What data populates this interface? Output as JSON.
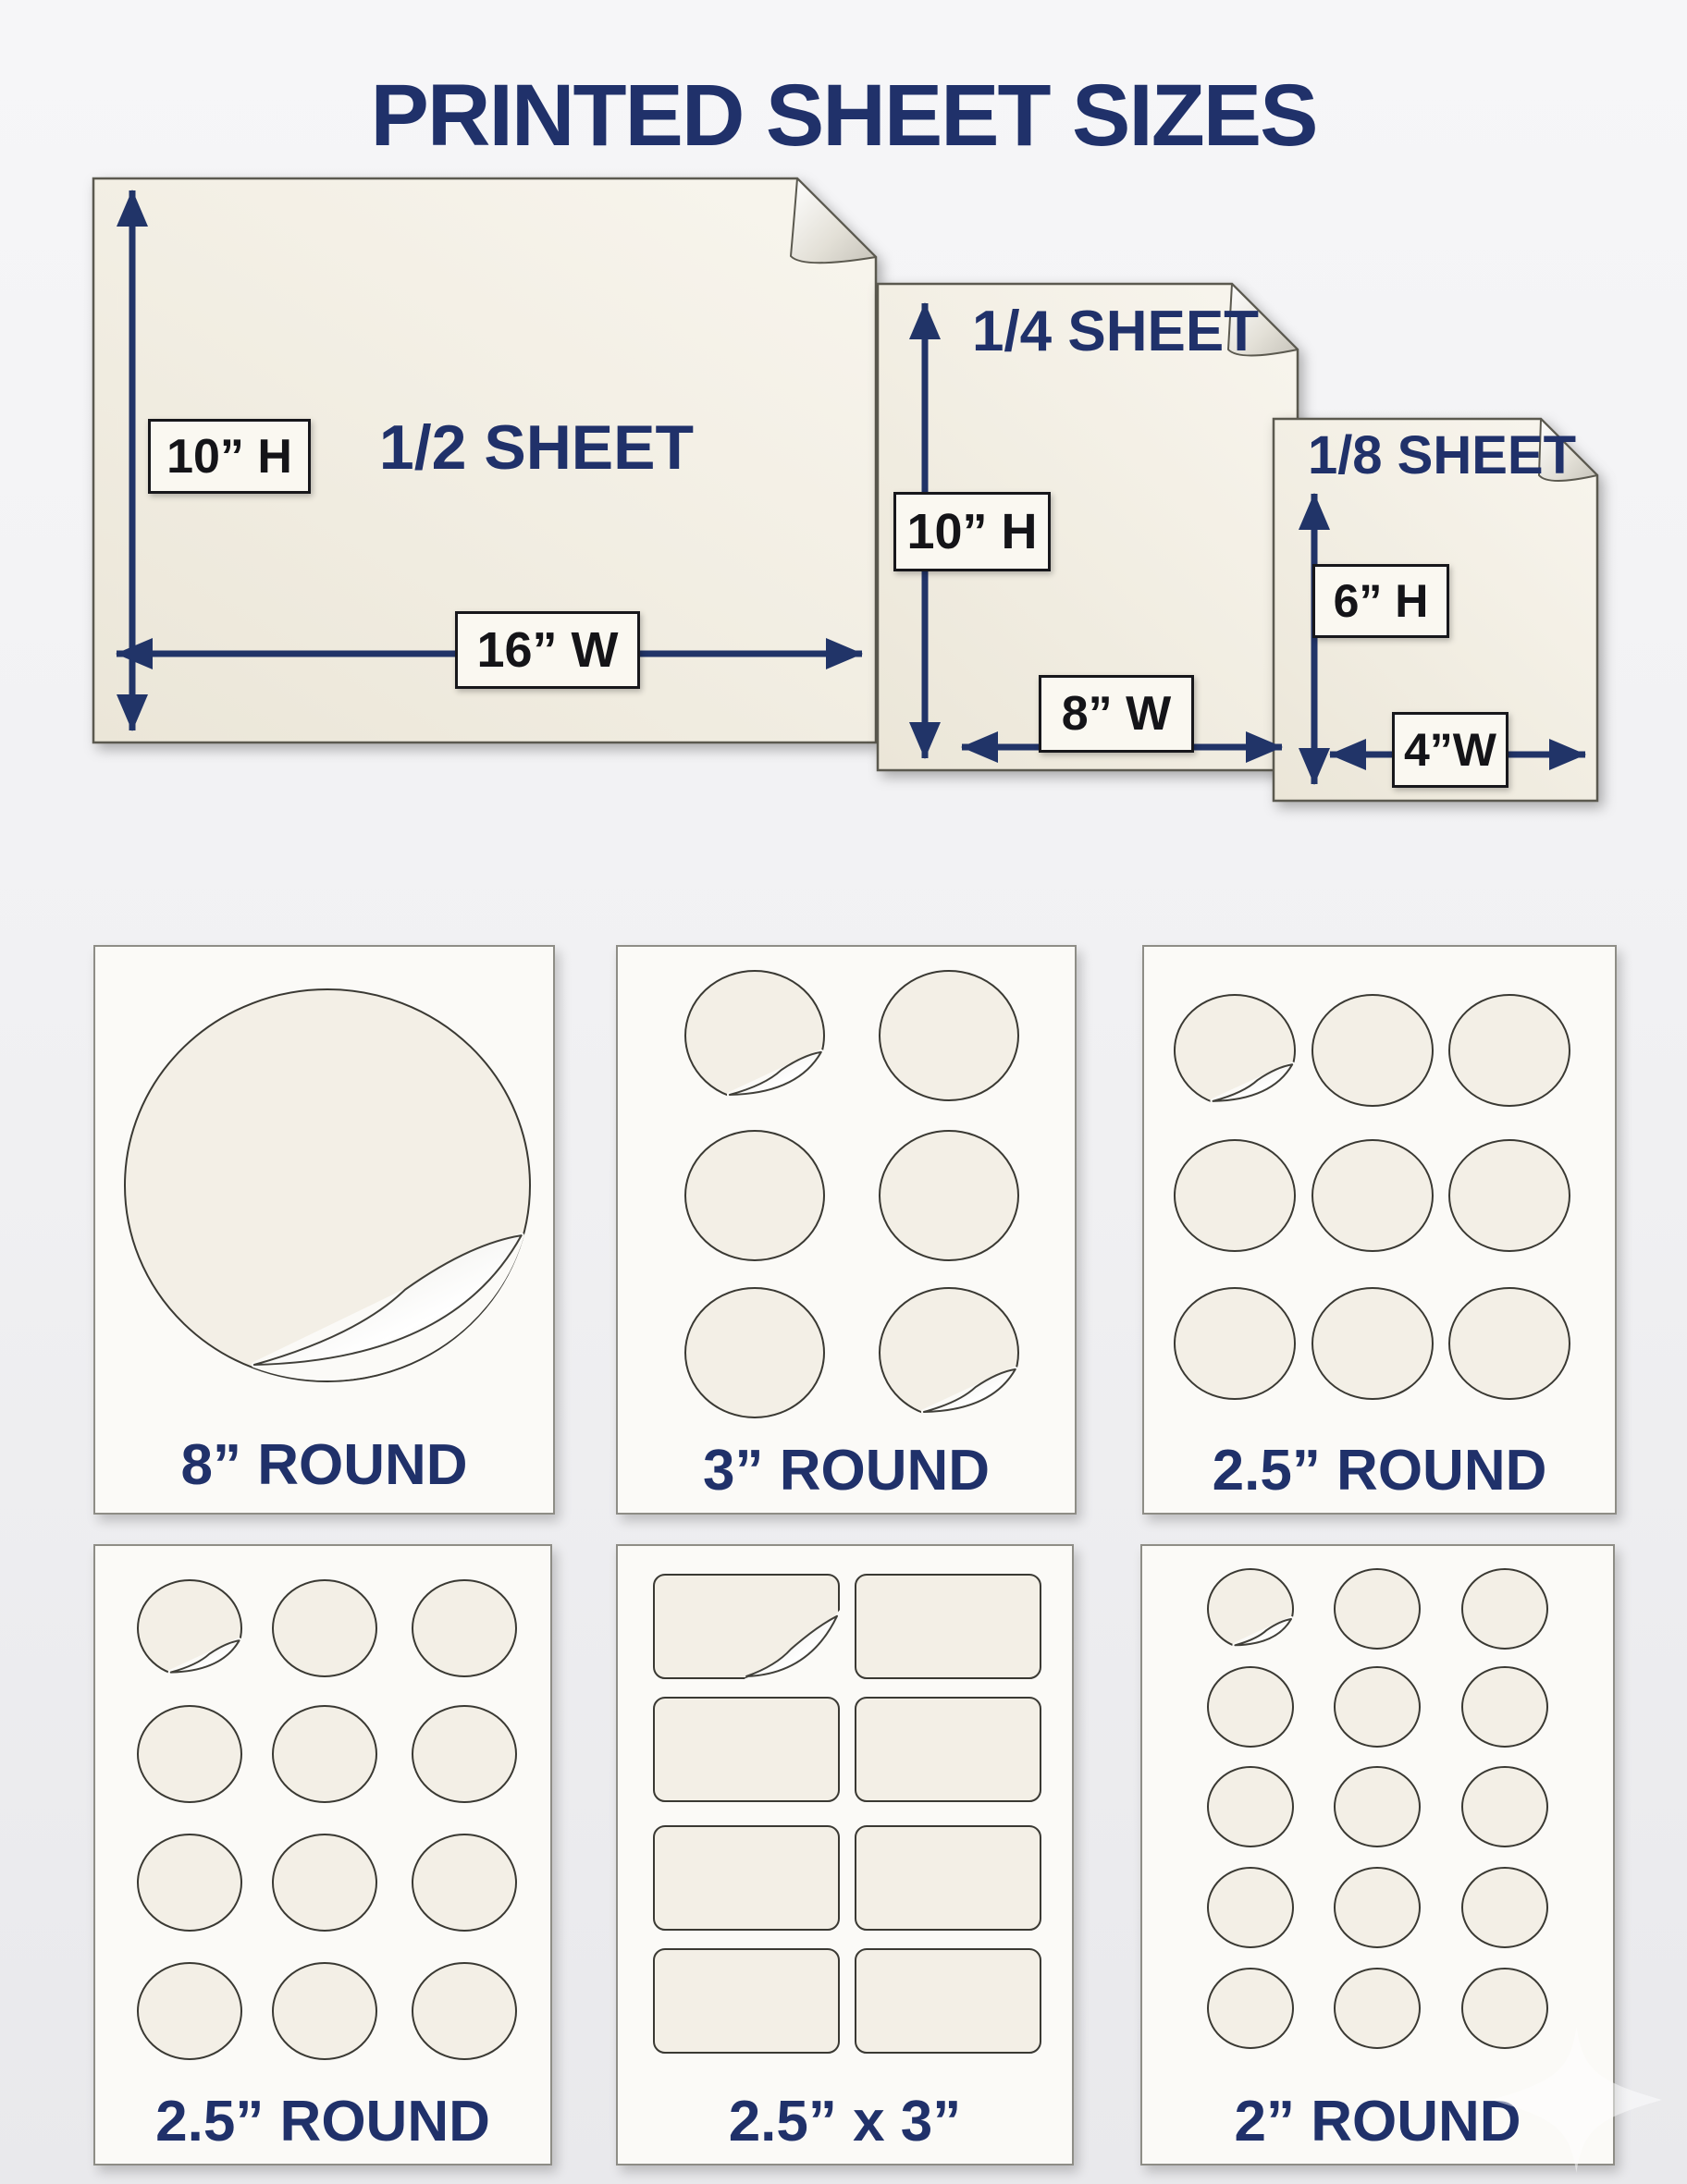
{
  "title": "PRINTED SHEET SIZES",
  "colors": {
    "navy_accent": "#20316a",
    "sheet_cream": "#f2eee3",
    "panel_background": "#fbfaf7",
    "sticker_outline": "#3a3933"
  },
  "sheets": [
    {
      "name": "1/2 SHEET",
      "height_label": "10” H",
      "width_label": "16” W"
    },
    {
      "name": "1/4 SHEET",
      "height_label": "10” H",
      "width_label": "8” W"
    },
    {
      "name": "1/8 SHEET",
      "height_label": "6” H",
      "width_label": "4”W"
    }
  ],
  "panels": [
    {
      "label": "8” ROUND",
      "shape": "circle",
      "cols": 1,
      "rows": 1,
      "sticker_count": 1,
      "peels": [
        0
      ]
    },
    {
      "label": "3” ROUND",
      "shape": "circle",
      "cols": 2,
      "rows": 3,
      "sticker_count": 6,
      "peels": [
        0,
        5
      ]
    },
    {
      "label": "2.5” ROUND",
      "shape": "circle",
      "cols": 3,
      "rows": 3,
      "sticker_count": 9,
      "peels": [
        0
      ]
    },
    {
      "label": "2.5” ROUND",
      "shape": "circle",
      "cols": 3,
      "rows": 4,
      "sticker_count": 12,
      "peels": [
        0
      ]
    },
    {
      "label": "2.5” x 3”",
      "shape": "rect",
      "cols": 2,
      "rows": 4,
      "sticker_count": 8,
      "peels": [
        0
      ]
    },
    {
      "label": "2” ROUND",
      "shape": "circle",
      "cols": 3,
      "rows": 5,
      "sticker_count": 15,
      "peels": [
        0
      ]
    }
  ]
}
